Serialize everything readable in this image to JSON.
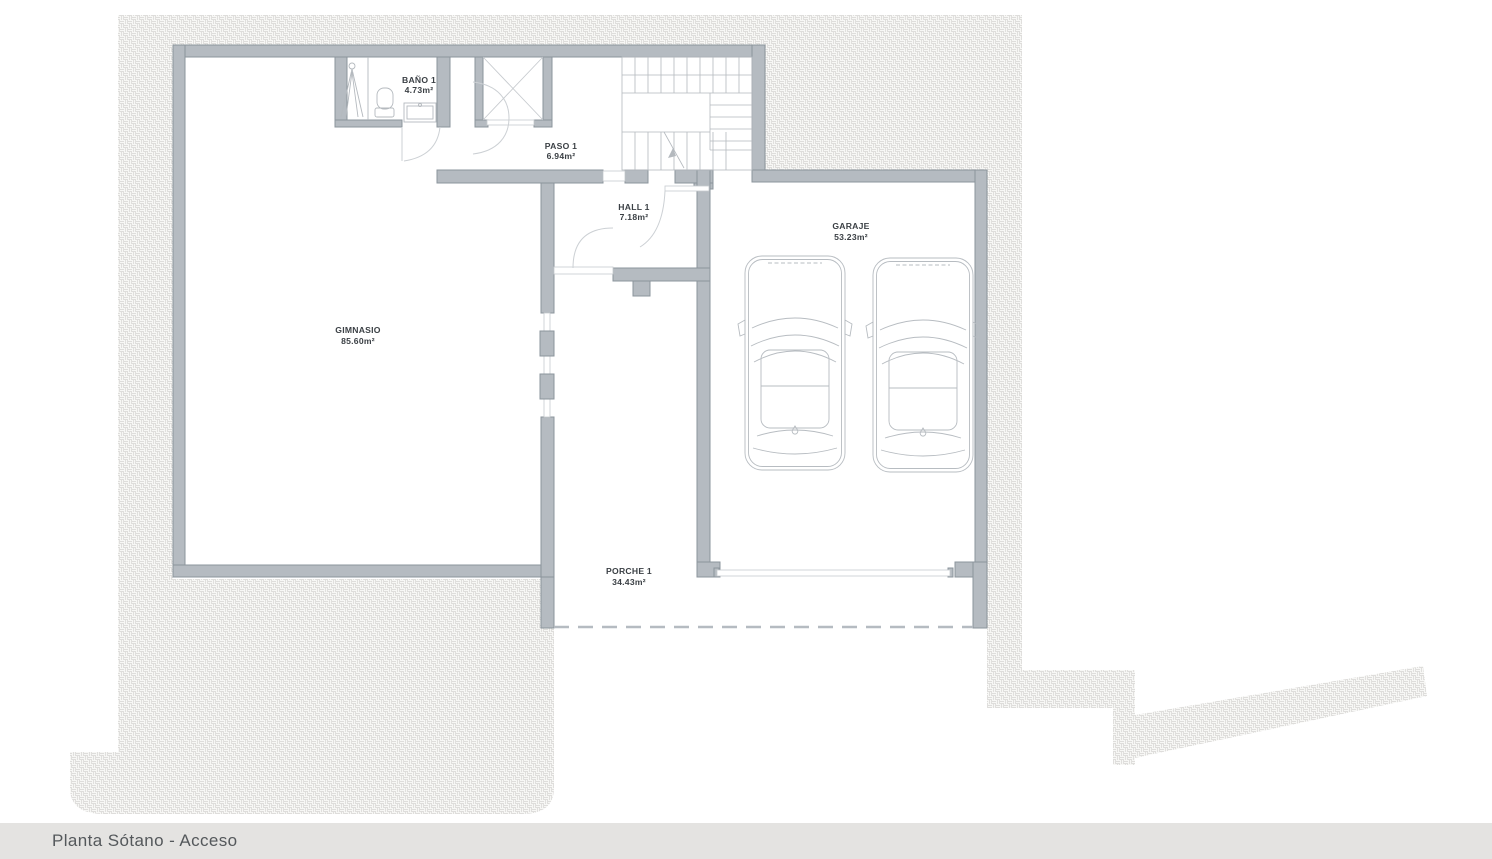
{
  "plan": {
    "title": "Planta Sótano - Acceso",
    "rooms": [
      {
        "id": "bano-1",
        "name": "BAÑO 1",
        "area": "4.73m²"
      },
      {
        "id": "paso-1",
        "name": "PASO 1",
        "area": "6.94m²"
      },
      {
        "id": "hall-1",
        "name": "HALL 1",
        "area": "7.18m²"
      },
      {
        "id": "garaje",
        "name": "GARAJE",
        "area": "53.23m²"
      },
      {
        "id": "gimnasio",
        "name": "GIMNASIO",
        "area": "85.60m²"
      },
      {
        "id": "porche-1",
        "name": "PORCHE 1",
        "area": "34.43m²"
      }
    ]
  },
  "colors": {
    "wall": "#b5bbc1",
    "wall_outline": "#8b949c",
    "hatch_line": "#dedddb",
    "hatch_base": "#f7f7f5",
    "thin_line": "#b4b9be",
    "door_arc": "#ccd0d4",
    "label": "#3b4045",
    "bar_bg": "#e4e3e1",
    "bar_text": "#54585b"
  }
}
